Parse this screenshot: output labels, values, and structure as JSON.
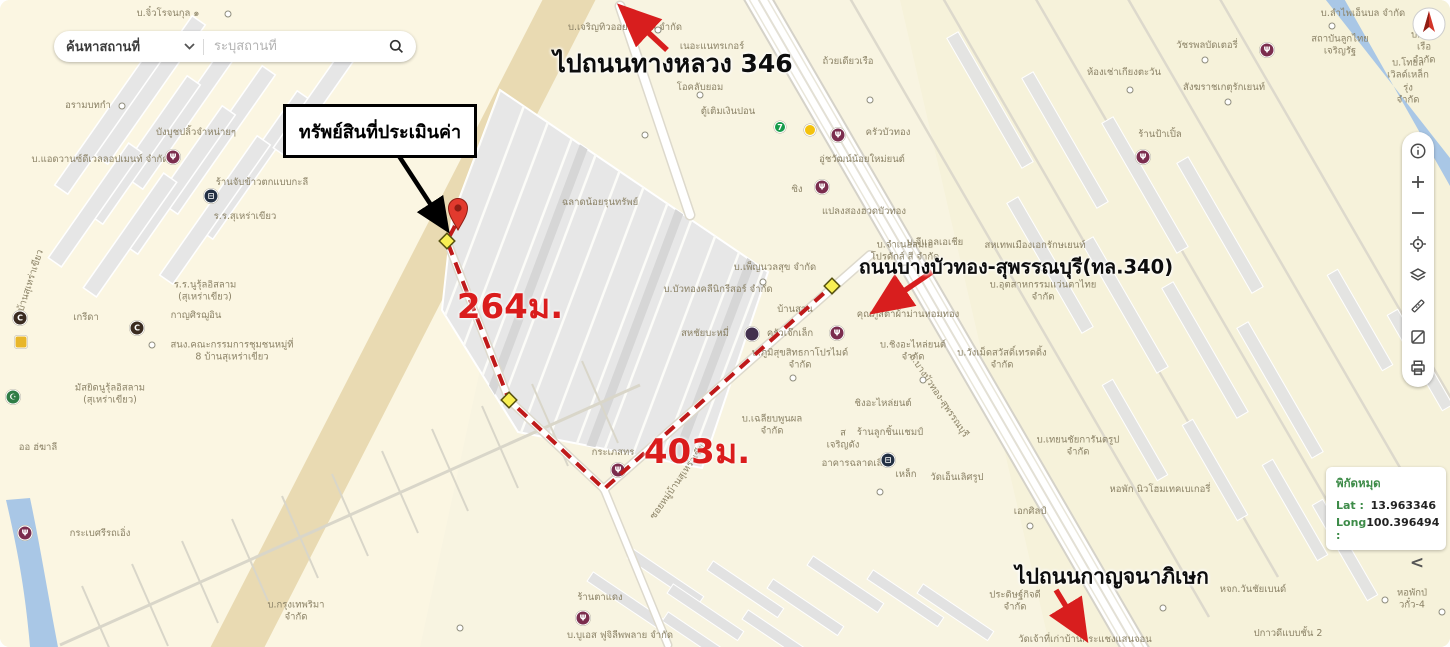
{
  "map": {
    "search": {
      "category": "ค้นหาสถานที่",
      "placeholder": "ระบุสถานที่"
    },
    "annotations": {
      "property_box": "ทรัพย์สินที่ประเมินค่า",
      "to_highway": "ไปถนนทางหลวง 346",
      "road_label": "ถนนบางบัวทอง-สุพรรณบุรี(ทล.340)",
      "to_kanchanaphisek": "ไปถนนกาญจนาภิเษก"
    },
    "route": {
      "pin": {
        "x": 458,
        "y": 213
      },
      "points": [
        [
          455,
          226
        ],
        [
          447,
          241
        ],
        [
          509,
          400
        ],
        [
          604,
          489
        ],
        [
          832,
          286
        ]
      ],
      "waypoints": [
        [
          447,
          241
        ],
        [
          509,
          400
        ],
        [
          832,
          286
        ]
      ],
      "distances": [
        {
          "text": "264ม.",
          "x": 510,
          "y": 306
        },
        {
          "text": "403ม.",
          "x": 697,
          "y": 451
        }
      ]
    },
    "coords_card": {
      "title": "พิกัดหมุด",
      "lat_label": "Lat :",
      "lat_value": "13.963346",
      "long_label": "Long :",
      "long_value": "100.396494"
    },
    "collapse_chevron": "<",
    "controls": [
      "info",
      "zoom-in",
      "zoom-out",
      "locate",
      "layers",
      "measure",
      "basemap",
      "print"
    ],
    "colors": {
      "annotation_red": "#d81e1e",
      "route_red": "#bf1a1a",
      "waypoint_yellow": "#f8ef53",
      "coords_green": "#3d8b48",
      "map_bg": "#f8f4e1",
      "canal_blue": "#a9c7e6"
    },
    "poi_glyphs": {
      "restaurant": "Ψ",
      "transit": "⊟",
      "coffee": "C",
      "mosque": "☪",
      "seven": "7",
      "fuel": "",
      "auto": "",
      "shop": "",
      "dot": ""
    },
    "pois": [
      {
        "type": "restaurant",
        "x": 173,
        "y": 157
      },
      {
        "type": "transit",
        "x": 211,
        "y": 196
      },
      {
        "type": "coffee",
        "x": 20,
        "y": 318
      },
      {
        "type": "coffee",
        "x": 137,
        "y": 328
      },
      {
        "type": "shop",
        "x": 21,
        "y": 342
      },
      {
        "type": "mosque",
        "x": 13,
        "y": 397
      },
      {
        "type": "restaurant",
        "x": 25,
        "y": 533
      },
      {
        "type": "restaurant",
        "x": 583,
        "y": 618
      },
      {
        "type": "restaurant",
        "x": 618,
        "y": 470
      },
      {
        "type": "seven",
        "x": 780,
        "y": 127
      },
      {
        "type": "fuel",
        "x": 810,
        "y": 130
      },
      {
        "type": "restaurant",
        "x": 838,
        "y": 135
      },
      {
        "type": "restaurant",
        "x": 822,
        "y": 187
      },
      {
        "type": "auto",
        "x": 752,
        "y": 334
      },
      {
        "type": "restaurant",
        "x": 837,
        "y": 333
      },
      {
        "type": "transit",
        "x": 888,
        "y": 460
      },
      {
        "type": "restaurant",
        "x": 1267,
        "y": 50
      },
      {
        "type": "restaurant",
        "x": 1143,
        "y": 157
      },
      {
        "type": "dot",
        "x": 228,
        "y": 14
      },
      {
        "type": "dot",
        "x": 283,
        "y": 58
      },
      {
        "type": "dot",
        "x": 122,
        "y": 106
      },
      {
        "type": "dot",
        "x": 152,
        "y": 345
      },
      {
        "type": "dot",
        "x": 870,
        "y": 100
      },
      {
        "type": "dot",
        "x": 905,
        "y": 268
      },
      {
        "type": "dot",
        "x": 923,
        "y": 380
      },
      {
        "type": "dot",
        "x": 1043,
        "y": 268
      },
      {
        "type": "dot",
        "x": 1205,
        "y": 60
      },
      {
        "type": "dot",
        "x": 1130,
        "y": 90
      },
      {
        "type": "dot",
        "x": 1228,
        "y": 102
      },
      {
        "type": "dot",
        "x": 1385,
        "y": 600
      },
      {
        "type": "dot",
        "x": 1030,
        "y": 526
      },
      {
        "type": "dot",
        "x": 645,
        "y": 135
      },
      {
        "type": "dot",
        "x": 700,
        "y": 95
      },
      {
        "type": "dot",
        "x": 763,
        "y": 282
      },
      {
        "type": "dot",
        "x": 793,
        "y": 378
      },
      {
        "type": "dot",
        "x": 880,
        "y": 492
      },
      {
        "type": "dot",
        "x": 658,
        "y": 30
      },
      {
        "type": "dot",
        "x": 460,
        "y": 628
      },
      {
        "type": "dot",
        "x": 1332,
        "y": 26
      },
      {
        "type": "dot",
        "x": 1442,
        "y": 612
      },
      {
        "type": "dot",
        "x": 1163,
        "y": 608
      }
    ],
    "map_labels": [
      {
        "x": 168,
        "y": 14,
        "t": "บ.จิ๋วโรจนกุล ๑"
      },
      {
        "x": 214,
        "y": 57,
        "t": "ร้านเสริมสวยมนา"
      },
      {
        "x": 88,
        "y": 106,
        "t": "อรามบทกำ"
      },
      {
        "x": 196,
        "y": 133,
        "t": "บังบูชปลิ้วจำหน่ายๆ"
      },
      {
        "x": 100,
        "y": 160,
        "t": "บ.แอดวานซ์ดีเวลลอปเมนท์ จำกัด"
      },
      {
        "x": 262,
        "y": 183,
        "t": "ร้านจับข้าวตกแบบกะลี"
      },
      {
        "x": 245,
        "y": 217,
        "t": "ร.ร.สุเหร่าเขียว"
      },
      {
        "x": 30,
        "y": 285,
        "rot": -72,
        "t": "ถ.บ้านสุเหร่าเขียว"
      },
      {
        "x": 205,
        "y": 292,
        "t": "ร.ร.นูรุ้ลอิสลาม\n(สุเหร่าเขียว)"
      },
      {
        "x": 196,
        "y": 316,
        "t": "กาญศิรฌูอิน"
      },
      {
        "x": 86,
        "y": 318,
        "t": "เกรีดา"
      },
      {
        "x": 232,
        "y": 352,
        "t": "สนง.คณะกรรมการชุมชนหมู่ที่\n8 บ้านสุเหร่าเขียว"
      },
      {
        "x": 110,
        "y": 395,
        "t": "มัสยิดนูรุ้ลอิสลาม\n(สุเหร่าเขียว)"
      },
      {
        "x": 38,
        "y": 448,
        "t": "ออ ฮ่ฆาลี"
      },
      {
        "x": 100,
        "y": 534,
        "t": "กระเบศรีรถเอิ่ง"
      },
      {
        "x": 296,
        "y": 612,
        "t": "บ.กรุงเทพริมา\nจำกัด"
      },
      {
        "x": 600,
        "y": 598,
        "t": "ร้านตาแดง"
      },
      {
        "x": 620,
        "y": 636,
        "t": "บ.บูเอส ฟูจิลีพพลาย จำกัด"
      },
      {
        "x": 625,
        "y": 28,
        "t": "บ.เจริญทิวออยล์ดีกรีส จำกัด"
      },
      {
        "x": 712,
        "y": 47,
        "t": "เนอะแนทรเกอร์"
      },
      {
        "x": 848,
        "y": 62,
        "t": "ถ้วยเดียวเรือ"
      },
      {
        "x": 700,
        "y": 88,
        "t": "โอคลับยอม"
      },
      {
        "x": 728,
        "y": 112,
        "t": "ตู้เติมเงินปอน"
      },
      {
        "x": 888,
        "y": 133,
        "t": "ครัวบัวทอง"
      },
      {
        "x": 862,
        "y": 160,
        "t": "อู่ชวัฒน์น้อยใหม่ยนต์"
      },
      {
        "x": 797,
        "y": 190,
        "t": "ซิง"
      },
      {
        "x": 864,
        "y": 212,
        "t": "แปลงสองฮวดบัวทอง"
      },
      {
        "x": 600,
        "y": 203,
        "t": "ฉลาดน้อยรุนทรัพย์"
      },
      {
        "x": 935,
        "y": 243,
        "t": "บ.จีแอลเอเชีย"
      },
      {
        "x": 1035,
        "y": 246,
        "t": "สหเทพเมืองเอกรักษเยนท์"
      },
      {
        "x": 905,
        "y": 252,
        "t": "บ.จำเนอสมเอ\nโปรดักส์ สี จำกัด"
      },
      {
        "x": 1043,
        "y": 292,
        "t": "บ.อุตสาหกรรมแว่นตาไทย\nจำกัด"
      },
      {
        "x": 908,
        "y": 315,
        "t": "คุณภูสิตาผ้าม่านหอมทอง"
      },
      {
        "x": 775,
        "y": 268,
        "t": "บ.เพ็ญนวลสุข จำกัด"
      },
      {
        "x": 718,
        "y": 290,
        "t": "บ.บัวทองคลีนิกรีสอร์ จำกัด"
      },
      {
        "x": 705,
        "y": 334,
        "t": "สหชัยบะหมี่"
      },
      {
        "x": 795,
        "y": 310,
        "t": "บ้านสวน"
      },
      {
        "x": 790,
        "y": 334,
        "t": "ครัวเจ๊กเล็ก"
      },
      {
        "x": 800,
        "y": 360,
        "t": "บ.ภูมิสุขสิทธกาโปรไมด์\nจำกัด"
      },
      {
        "x": 913,
        "y": 352,
        "t": "บ.ชิงอะไหล่ยนต์\nจำกัด"
      },
      {
        "x": 1002,
        "y": 360,
        "t": "บ.วังเม็ดสวัสดิ์เทรดดิ้ง\nจำกัด"
      },
      {
        "x": 883,
        "y": 404,
        "t": "ชิงอะไหล่ยนต์"
      },
      {
        "x": 772,
        "y": 426,
        "t": "บ.เฉลียบพูนผล\nจำกัด"
      },
      {
        "x": 890,
        "y": 433,
        "t": "ร้านลูกชิ้นแชมป์"
      },
      {
        "x": 843,
        "y": 440,
        "t": "ส\nเจริญดัง"
      },
      {
        "x": 855,
        "y": 464,
        "t": "อาคารฉลาดเลิศ"
      },
      {
        "x": 906,
        "y": 475,
        "t": "เหล็ก"
      },
      {
        "x": 957,
        "y": 478,
        "t": "วัดเอ็นเลิศรูป"
      },
      {
        "x": 1030,
        "y": 512,
        "t": "เอกศิลป์"
      },
      {
        "x": 1078,
        "y": 447,
        "t": "บ.เทยนชัยการันตรูป\nจำกัด"
      },
      {
        "x": 1160,
        "y": 490,
        "t": "หอพัก นิวโฮมเทคเบเกอรี่"
      },
      {
        "x": 1253,
        "y": 590,
        "t": "หจก.วันชัยเบนด์"
      },
      {
        "x": 1288,
        "y": 634,
        "t": "ปกาวดีแบบชั้น 2"
      },
      {
        "x": 1015,
        "y": 602,
        "t": "ประดิษฐ์กิจดี\nจำกัด"
      },
      {
        "x": 1085,
        "y": 640,
        "t": "วัดเจ้าที่เก่าบ้านกระแชงแสนจอน"
      },
      {
        "x": 1412,
        "y": 600,
        "t": "หอพักป่วกั๋ว-4"
      },
      {
        "x": 1363,
        "y": 14,
        "t": "บ.ลำไพเอ็นบล จำกัด"
      },
      {
        "x": 1340,
        "y": 46,
        "t": "สถาบันลูกไทย\nเจริญรัฐ"
      },
      {
        "x": 1424,
        "y": 48,
        "t": "บ.ทองเรือ\nจำกัด"
      },
      {
        "x": 1408,
        "y": 82,
        "t": "บ.โทยลเวิลด์เหล็กรุ่ง\nจำกัด"
      },
      {
        "x": 1207,
        "y": 46,
        "t": "วัชรพลบัดเตอรี่"
      },
      {
        "x": 1124,
        "y": 73,
        "t": "ห้องเช่าเกียงตะวัน"
      },
      {
        "x": 1224,
        "y": 88,
        "t": "สังฆราชเกตุรักเยนท์"
      },
      {
        "x": 1160,
        "y": 135,
        "t": "ร้านป้าเปิ้ล"
      },
      {
        "x": 613,
        "y": 453,
        "t": "กระเภสทร"
      },
      {
        "x": 680,
        "y": 480,
        "rot": -55,
        "t": "ซอยหมู่บ้านสุเหร่าเขียว"
      },
      {
        "x": 938,
        "y": 396,
        "rot": 56,
        "t": "ถ.บางบัวทอง-สุพรรณบุรี"
      }
    ]
  }
}
